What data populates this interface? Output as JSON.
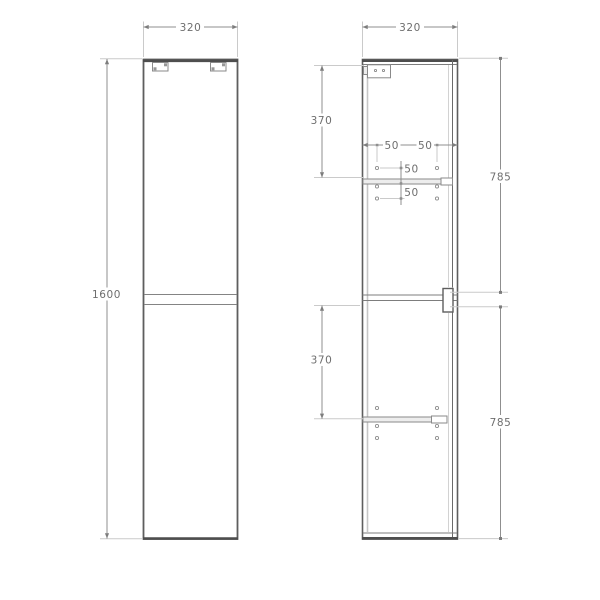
{
  "drawing": {
    "title": "tall-cabinet-technical-drawing",
    "front_view": {
      "width": "320",
      "height": "1600"
    },
    "section_view": {
      "width": "320",
      "upper_shelf_from_top": "370",
      "lower_shelf_from_mid": "370",
      "hole_inset_left": "50",
      "hole_inset_right": "50",
      "hole_above_shelf": "50",
      "hole_below_shelf": "50",
      "upper_section_height": "785",
      "lower_section_height": "785"
    },
    "colors": {
      "outline": "#5e5e5e",
      "heavy_edge": "#4e4e4e",
      "dimension_line": "#8f8f8f",
      "extension_line": "#cacaca",
      "text": "#6e6e6e"
    }
  }
}
